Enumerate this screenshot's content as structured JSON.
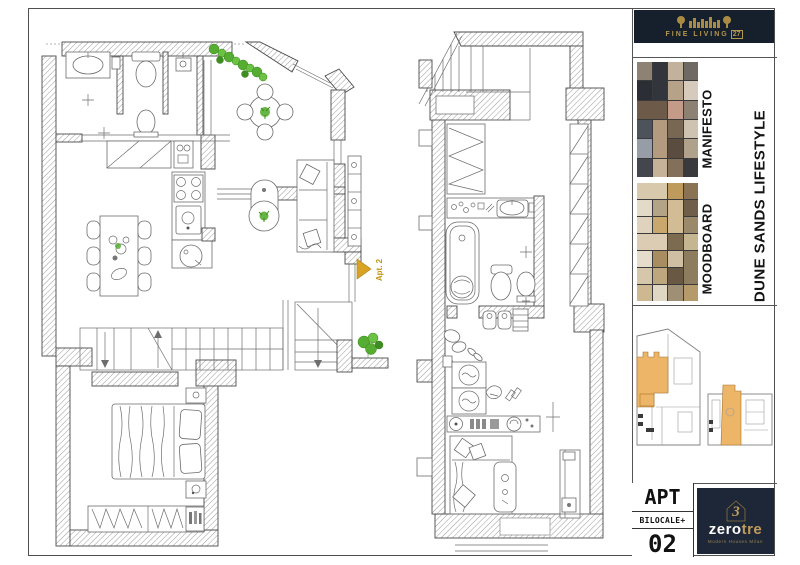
{
  "sheet": {
    "bg": "#ffffff",
    "frame_color": "#4f4f4f"
  },
  "fine_living_logo": {
    "brand": "FINE LIVING",
    "number": "27",
    "bg": "#16202d",
    "gold": "#b3954e"
  },
  "sidebar": {
    "manifesto_label": "MANIFESTO",
    "moodboard_label": "MOODBOARD",
    "lifestyle_label": "DUNE SANDS LIFESTYLE",
    "manifesto_tiles": [
      "#8e8274",
      "#33353d",
      "#c2b29b",
      "#6e6a63",
      "#2c2e36",
      "#b5a289",
      "#6d5a49",
      "#d5cabc",
      "#c49b88",
      "#8c8172",
      "#4e525a",
      "#b49b7f",
      "#776753",
      "#cec2b0",
      "#979da6",
      "#5a4c3e",
      "#b0a18b",
      "#44464e",
      "#c6b298",
      "#83705a"
    ],
    "moodboard_tiles": [
      "#d8c8ac",
      "#bf9a5d",
      "#8a7355",
      "#e3dac8",
      "#b4a487",
      "#d2bc96",
      "#6e5e4a",
      "#dfd3be",
      "#c9a86d",
      "#9b896c",
      "#dbccb3",
      "#7c6b51",
      "#c6b591",
      "#e6dccb",
      "#a88d61",
      "#d0bfa2",
      "#8e7c5e",
      "#d7c7aa",
      "#bea77e",
      "#695944",
      "#cdb892",
      "#e0d6c4",
      "#9f8f74",
      "#b59a6b"
    ]
  },
  "keyplan": {
    "highlight_color": "#ecb568"
  },
  "plans": {
    "marker_label": "Apt. 2",
    "marker_color": "#d8a224",
    "plant_color": "#55ad31",
    "wall_line_color": "#4a4a4a"
  },
  "titleblock": {
    "apt_label": "APT",
    "type_label": "BILOCALE+",
    "number": "02"
  },
  "zerotre_logo": {
    "zero": "zero",
    "tre": "tre",
    "icon_number": "3",
    "tagline": "Modern Houses Milan",
    "bg": "#1d2737",
    "gold": "#c09a5a"
  }
}
